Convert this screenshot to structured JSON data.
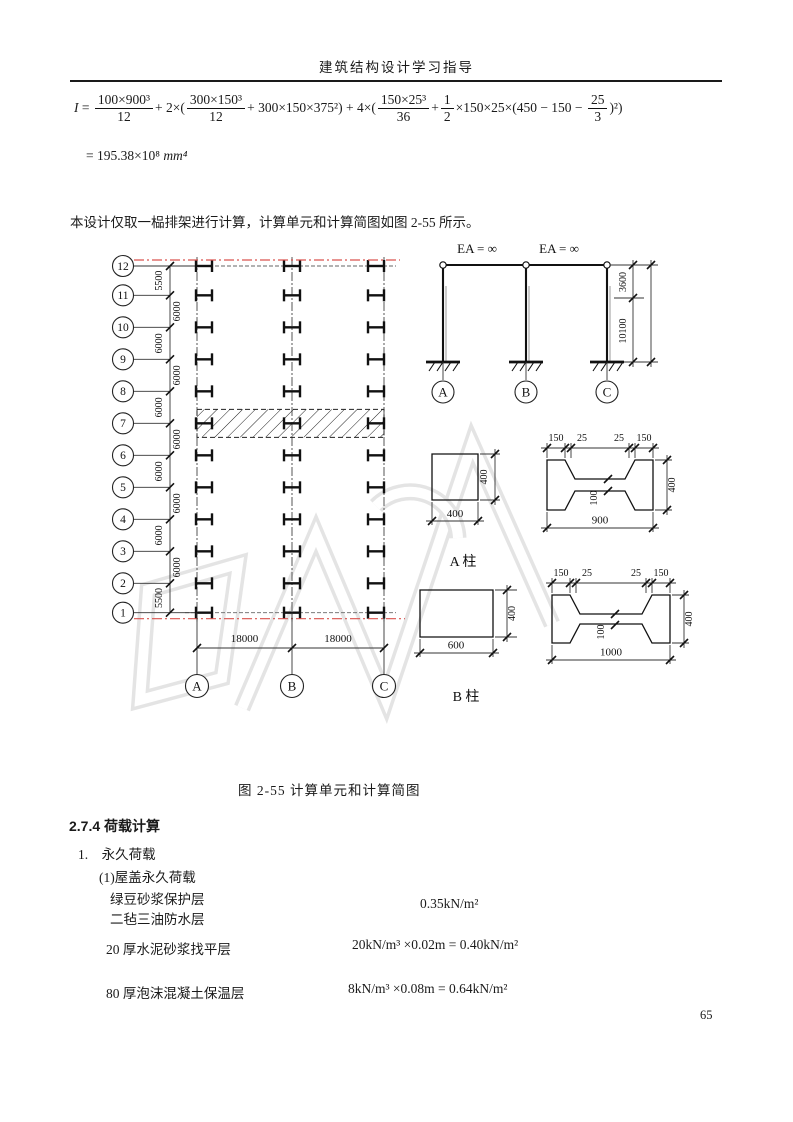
{
  "header": {
    "title": "建筑结构设计学习指导"
  },
  "formula": {
    "var": "I",
    "eq": " = ",
    "f1n": "100×900³",
    "f1d": "12",
    "t1": "+ 2×(",
    "f2n": "300×150³",
    "f2d": "12",
    "t2": "+ 300×150×375²) + 4×(",
    "f3n": "150×25³",
    "f3d": "36",
    "t3": "+",
    "f4n": "1",
    "f4d": "2",
    "t4": "×150×25×(450 − 150 − ",
    "f5n": "25",
    "f5d": "3",
    "t5": ")²)",
    "result": "= 195.38×10⁸ ",
    "result_unit": "mm⁴"
  },
  "paragraph": "本设计仅取一榀排架进行计算，计算单元和计算简图如图 2-55 所示。",
  "figure": {
    "caption": "图 2-55  计算单元和计算简图",
    "plan": {
      "row_labels": [
        "12",
        "11",
        "10",
        "9",
        "8",
        "7",
        "6",
        "5",
        "4",
        "3",
        "2",
        "1"
      ],
      "row_dims": [
        "5500",
        "6000",
        "6000",
        "6000",
        "6000",
        "6000",
        "6000",
        "6000",
        "6000",
        "6000",
        "5500"
      ],
      "col_labels": [
        "A",
        "B",
        "C"
      ],
      "span_dims": [
        "18000",
        "18000"
      ]
    },
    "frame": {
      "ea_labels": [
        "EA = ∞",
        "EA = ∞"
      ],
      "dim_top": "3600",
      "dim_total": "10100",
      "col_labels": [
        "A",
        "B",
        "C"
      ]
    },
    "section_a": {
      "label": "A 柱",
      "square": {
        "w": "400",
        "h": "400"
      },
      "ishape": {
        "top_dims": [
          "150",
          "25",
          "25",
          "150"
        ],
        "height": "400",
        "web": "100",
        "width": "900"
      }
    },
    "section_b": {
      "label": "B 柱",
      "rect": {
        "w": "600",
        "h": "400"
      },
      "ishape": {
        "top_dims": [
          "150",
          "25",
          "25",
          "150"
        ],
        "height": "400",
        "web": "100",
        "width": "1000"
      }
    }
  },
  "section": {
    "heading": "2.7.4 荷载计算",
    "item1": "1.　永久荷载",
    "sub1": "(1)屋盖永久荷载",
    "loads": [
      {
        "name": "绿豆砂浆保护层",
        "name2": "二毡三油防水层",
        "value": "0.35kN/m²"
      },
      {
        "name": "20 厚水泥砂浆找平层",
        "value": "20kN/m³ ×0.02m = 0.40kN/m²"
      },
      {
        "name": "80 厚泡沫混凝土保温层",
        "value": "8kN/m³ ×0.08m = 0.64kN/m²"
      }
    ]
  },
  "page_number": "65",
  "colors": {
    "centerline_red": "#d9534f",
    "line": "#1a1a1a",
    "watermark": "#e4e4e4"
  }
}
